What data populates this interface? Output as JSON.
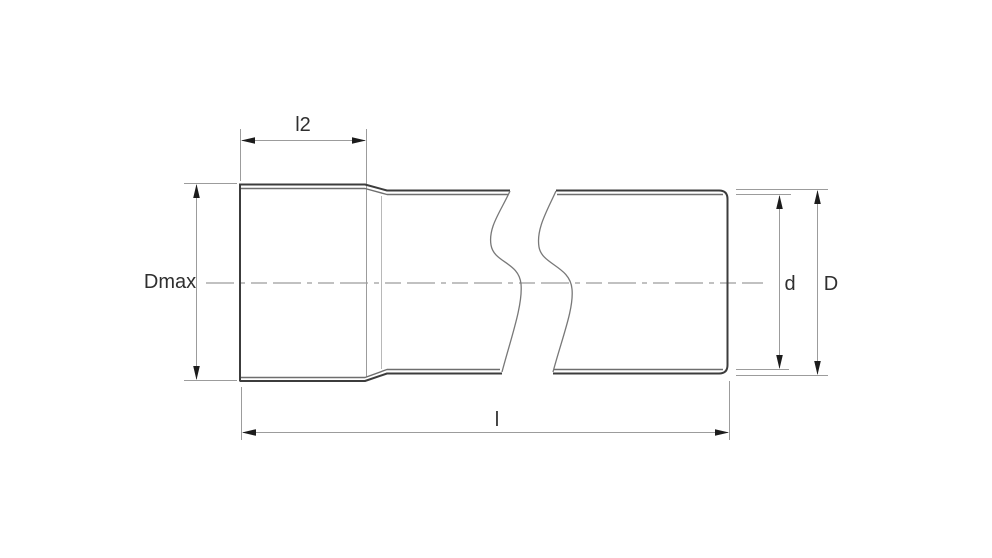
{
  "diagram": {
    "dimension_labels": {
      "l2": "l2",
      "dmax": "Dmax",
      "d": "d",
      "D": "D",
      "l": "l"
    },
    "colors": {
      "background": "#ffffff",
      "pipe_outline": "#3c3c3c",
      "pipe_inner_line": "#6e6e6e",
      "dimension_lines": "#9c9c9c",
      "arrowheads": "#1c1c1c",
      "label_text": "#2f2f2f",
      "centerline": "#9c9c9c"
    }
  }
}
